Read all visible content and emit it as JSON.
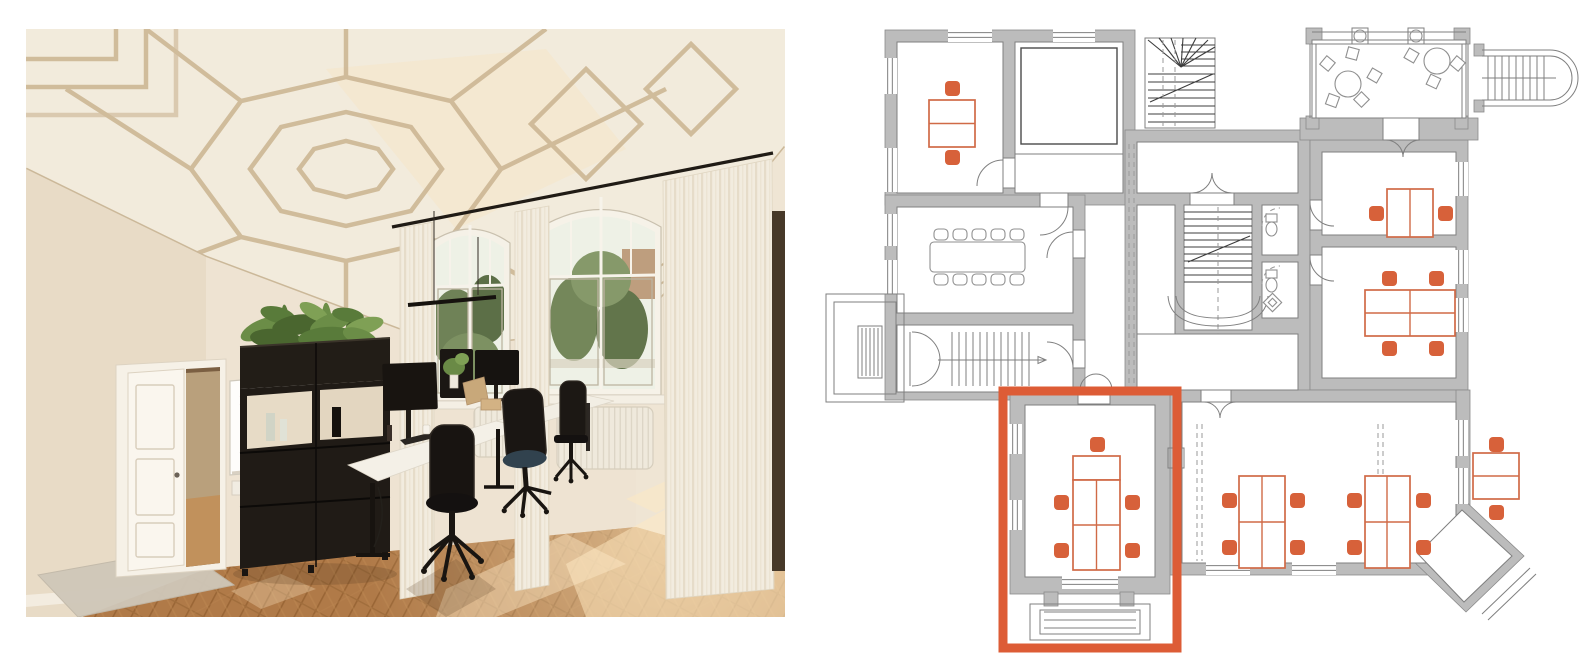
{
  "page": {
    "background": "#ffffff",
    "layout": "photo-left-floorplan-right"
  },
  "photo": {
    "palette": {
      "ceiling": "#f2ebdc",
      "ceiling_ribs": "#cdb795",
      "wall_back": "#eee3d2",
      "wall_left": "#e8dbc6",
      "floor_wood": "#b07a48",
      "floor_seam": "#9a6636",
      "sunlight": "#ffe9c2",
      "curtain": "#f2ecdf",
      "curtain_fold": "#e6dcc9",
      "window_sky": "#eef1e6",
      "window_trees": "#6f8257",
      "black_furniture": "#201b16",
      "desk_top": "#f4f0e7",
      "plant_green": "#6b8d47",
      "mat_gray": "#cfc7b9",
      "hall_through_door": "#c1915c",
      "curtain_rod": "#201b15"
    },
    "inventory": {
      "windows": 2,
      "monitors": 3,
      "office_chairs": 3,
      "doors_open": 1,
      "whiteboards": 1,
      "plant_divider_units": 1,
      "radiators": 2,
      "pendant_lights": 1
    }
  },
  "floor_plan": {
    "colors": {
      "wall": "#bcbcbc",
      "wall_stroke": "#8a8a8a",
      "line": "#7f7f7f",
      "dark": "#3c3c3c",
      "dash": "#9a9a9a",
      "gray_furniture": "#8f8f8f",
      "accent": "#d7613a",
      "desk_stroke": "#d06a47",
      "highlight": "#dd5c36",
      "room": "#ffffff"
    },
    "highlight_room": {
      "x": 1003,
      "y": 391,
      "w": 174,
      "h": 257,
      "stroke_width": 9
    },
    "walls": [
      [
        885,
        30,
        250,
        175
      ],
      [
        885,
        195,
        200,
        205
      ],
      [
        1125,
        130,
        185,
        270
      ],
      [
        1310,
        140,
        158,
        250
      ],
      [
        1170,
        390,
        298,
        185
      ],
      [
        1010,
        392,
        160,
        202
      ],
      [
        1300,
        118,
        178,
        22
      ],
      [
        1456,
        390,
        14,
        128
      ],
      [
        1306,
        28,
        16,
        16
      ],
      [
        1454,
        28,
        16,
        16
      ],
      [
        1306,
        116,
        13,
        13
      ],
      [
        1455,
        116,
        13,
        13
      ],
      [
        1044,
        592,
        14,
        14
      ],
      [
        1120,
        592,
        14,
        14
      ],
      [
        1474,
        44,
        10,
        12
      ],
      [
        1474,
        100,
        10,
        12
      ]
    ],
    "wall_polys": [
      "1462,498 1524,556 1466,612 1406,554"
    ],
    "rooms": [
      [
        897,
        42,
        106,
        151
      ],
      [
        1015,
        42,
        108,
        151
      ],
      [
        897,
        207,
        176,
        106
      ],
      [
        897,
        325,
        176,
        67
      ],
      [
        1137,
        142,
        161,
        51
      ],
      [
        1137,
        205,
        38,
        187
      ],
      [
        1184,
        205,
        68,
        125
      ],
      [
        1262,
        205,
        36,
        50
      ],
      [
        1262,
        262,
        36,
        56
      ],
      [
        1137,
        334,
        161,
        56
      ],
      [
        1322,
        152,
        134,
        83
      ],
      [
        1322,
        247,
        134,
        131
      ],
      [
        1182,
        402,
        274,
        161
      ],
      [
        1025,
        405,
        130,
        172
      ],
      [
        1312,
        40,
        154,
        78
      ],
      [
        1078,
        390,
        32,
        14
      ],
      [
        1383,
        118,
        36,
        22
      ],
      [
        1190,
        193,
        44,
        12
      ],
      [
        1310,
        200,
        12,
        30
      ],
      [
        1310,
        255,
        12,
        30
      ],
      [
        1201,
        390,
        30,
        12
      ],
      [
        1073,
        230,
        12,
        28
      ],
      [
        1073,
        340,
        12,
        28
      ],
      [
        1003,
        158,
        12,
        30
      ],
      [
        1040,
        193,
        28,
        14
      ]
    ],
    "room_polys": [
      "1462,510 1512,556 1464,602 1418,554"
    ],
    "windows": [
      [
        948,
        28,
        44,
        14
      ],
      [
        1053,
        28,
        42,
        14
      ],
      [
        883,
        58,
        14,
        36
      ],
      [
        883,
        148,
        14,
        44
      ],
      [
        883,
        214,
        14,
        32
      ],
      [
        883,
        260,
        14,
        34
      ],
      [
        1454,
        162,
        14,
        34
      ],
      [
        1454,
        250,
        14,
        34
      ],
      [
        1454,
        298,
        14,
        34
      ],
      [
        1454,
        420,
        14,
        36
      ],
      [
        1454,
        468,
        14,
        36
      ],
      [
        1206,
        561,
        44,
        14
      ],
      [
        1292,
        561,
        44,
        14
      ],
      [
        1062,
        575,
        56,
        14
      ],
      [
        1008,
        424,
        14,
        30
      ],
      [
        1008,
        500,
        14,
        30
      ]
    ],
    "outline_rects": [
      [
        826,
        294,
        78,
        108
      ],
      [
        834,
        302,
        62,
        92
      ],
      [
        858,
        326,
        24,
        52
      ],
      [
        1030,
        604,
        120,
        36
      ],
      [
        1040,
        610,
        100,
        24
      ],
      [
        1168,
        448,
        16,
        20
      ],
      [
        1352,
        28,
        16,
        16
      ],
      [
        1408,
        28,
        16,
        16
      ],
      [
        1145,
        38,
        70,
        90
      ]
    ],
    "dark_rects": [
      [
        1021,
        48,
        96,
        96
      ]
    ],
    "lines": [
      [
        1015,
        154,
        1123,
        154
      ],
      [
        1312,
        32,
        1466,
        32
      ],
      [
        1312,
        44,
        1466,
        44
      ],
      [
        1310,
        44,
        1310,
        118
      ],
      [
        1316,
        44,
        1316,
        118
      ],
      [
        1462,
        44,
        1462,
        118
      ],
      [
        1468,
        44,
        1468,
        118
      ],
      [
        1482,
        50,
        1550,
        50
      ],
      [
        1482,
        56,
        1550,
        56
      ],
      [
        1482,
        100,
        1550,
        100
      ],
      [
        1482,
        106,
        1550,
        106
      ],
      [
        1482,
        78,
        1556,
        78
      ],
      [
        910,
        332,
        910,
        386
      ],
      [
        938,
        360,
        1046,
        360
      ],
      [
        1482,
        614,
        1530,
        568
      ],
      [
        1488,
        620,
        1536,
        574
      ]
    ],
    "line_gens": [
      {
        "g": "tv",
        "x0": 862,
        "dx": 4,
        "n": 5,
        "y1": 328,
        "y2": 376
      },
      {
        "g": "th",
        "y0": 612,
        "dy": 8,
        "n": 3,
        "x1": 1044,
        "x2": 1136
      },
      {
        "g": "tv",
        "x0": 952,
        "dx": 7,
        "n": 12,
        "y1": 332,
        "y2": 386
      },
      {
        "g": "tv",
        "x0": 1488,
        "dx": 7,
        "n": 9,
        "y1": 56,
        "y2": 100
      }
    ],
    "dark_lines": [
      [
        1181,
        67,
        1148,
        40
      ],
      [
        1181,
        67,
        1159,
        38
      ],
      [
        1181,
        67,
        1171,
        38
      ],
      [
        1181,
        67,
        1183,
        38
      ],
      [
        1181,
        67,
        1196,
        38
      ],
      [
        1181,
        67,
        1208,
        40
      ],
      [
        1181,
        67,
        1215,
        47
      ],
      [
        1150,
        102,
        1213,
        74
      ],
      [
        1188,
        262,
        1250,
        236
      ]
    ],
    "dark_gens": [
      {
        "g": "th",
        "y0": 45,
        "dy": 7,
        "n": 4,
        "x1": 1181,
        "x2": 1215
      },
      {
        "g": "th",
        "y0": 74,
        "dy": 8,
        "n": 7,
        "x1": 1148,
        "x2": 1215
      },
      {
        "g": "th",
        "y0": 212,
        "dy": 7,
        "n": 11,
        "x1": 1184,
        "x2": 1252
      }
    ],
    "dashes": [
      [
        1129,
        144,
        1129,
        388
      ],
      [
        1134,
        144,
        1134,
        388
      ],
      [
        1197,
        424,
        1197,
        561
      ],
      [
        1202,
        424,
        1202,
        561
      ],
      [
        1378,
        424,
        1378,
        561
      ],
      [
        1383,
        424,
        1383,
        561
      ],
      [
        1218,
        207,
        1218,
        334
      ],
      [
        1163,
        40,
        1163,
        126
      ],
      [
        1175,
        40,
        1175,
        126
      ]
    ],
    "paths": [
      "M1168,296 Q1170,326 1218,326 Q1266,326 1268,296",
      "M1176,296 Q1178,318 1218,318 Q1258,318 1260,296",
      "M1550,50 A28,28 0 0 1 1550,106",
      "M1550,56 A22,22 0 0 1 1550,100",
      "M1003,160 A26,26 0 0 0 977,186",
      "M1068,207 A28,28 0 0 1 1040,235",
      "M1073,232 A26,26 0 0 0 1047,258",
      "M1073,368 A26,26 0 0 0 1047,342",
      "M1192,193 A20,20 0 0 0 1212,173",
      "M1232,193 A20,20 0 0 1 1212,173",
      "M1386,140 A17,17 0 0 1 1403,157",
      "M1420,140 A17,17 0 0 0 1403,157",
      "M1310,202 A24,24 0 0 0 1334,226",
      "M1310,257 A24,24 0 0 0 1334,281",
      "M1204,402 A16,16 0 0 1 1220,418",
      "M1236,402 A16,16 0 0 0 1220,418",
      "M1080,390 A16,16 0 0 1 1096,374",
      "M1112,390 A16,16 0 0 0 1096,374",
      "M912,332 A28,28 0 0 1 940,360",
      "M912,386 A28,28 0 0 0 940,358",
      "M1046,360 l-8,-3.5 l0,7 Z"
    ],
    "dash_paths": [
      "M1262,226 A18,18 0 0 1 1280,208",
      "M1262,284 A18,18 0 0 1 1280,266"
    ],
    "desks": [
      {
        "x": 929,
        "y": 100,
        "w": 46,
        "h": 47,
        "vx": [],
        "hy": [
          123.5
        ]
      },
      {
        "x": 1387,
        "y": 189,
        "w": 46,
        "h": 48,
        "vx": [
          1410
        ],
        "hy": []
      },
      {
        "x": 1365,
        "y": 290,
        "w": 90,
        "h": 46,
        "vx": [
          1410
        ],
        "hy": [
          313
        ]
      },
      {
        "x": 1073,
        "y": 456,
        "w": 47,
        "h": 24,
        "vx": [],
        "hy": []
      },
      {
        "x": 1073,
        "y": 480,
        "w": 47,
        "h": 90,
        "vx": [
          1096.5
        ],
        "hy": [
          525
        ]
      },
      {
        "x": 1239,
        "y": 476,
        "w": 46,
        "h": 92,
        "vx": [
          1262
        ],
        "hy": [
          522
        ]
      },
      {
        "x": 1365,
        "y": 476,
        "w": 45,
        "h": 92,
        "vx": [
          1387
        ],
        "hy": [
          522
        ]
      },
      {
        "x": 1473,
        "y": 453,
        "w": 46,
        "h": 46,
        "vx": [],
        "hy": [
          476
        ]
      }
    ],
    "chairs": [
      [
        945,
        81
      ],
      [
        945,
        150
      ],
      [
        1369,
        206
      ],
      [
        1438,
        206
      ],
      [
        1382,
        271
      ],
      [
        1429,
        271
      ],
      [
        1382,
        341
      ],
      [
        1429,
        341
      ],
      [
        1090,
        437
      ],
      [
        1054,
        495
      ],
      [
        1054,
        543
      ],
      [
        1125,
        495
      ],
      [
        1125,
        543
      ],
      [
        1222,
        493
      ],
      [
        1222,
        540
      ],
      [
        1290,
        493
      ],
      [
        1290,
        540
      ],
      [
        1347,
        493
      ],
      [
        1347,
        540
      ],
      [
        1416,
        493
      ],
      [
        1416,
        540
      ],
      [
        1489,
        437
      ],
      [
        1489,
        505
      ]
    ],
    "chair_size": 15,
    "conference": {
      "table": [
        930,
        242,
        95,
        30
      ],
      "chair_xs": [
        934,
        953,
        972,
        991,
        1010
      ],
      "rows_y": [
        229,
        274
      ],
      "chair_w": 14,
      "chair_h": 11
    },
    "round_tables": [
      [
        1348,
        84,
        13
      ],
      [
        1437,
        61,
        13
      ]
    ],
    "column_circles": [
      [
        1360,
        36,
        6
      ],
      [
        1416,
        36,
        6
      ]
    ],
    "terrace_chairs": [
      {
        "x": 1322,
        "y": 58,
        "rot": 40
      },
      {
        "x": 1347,
        "y": 48,
        "rot": 15
      },
      {
        "x": 1369,
        "y": 70,
        "rot": 30
      },
      {
        "x": 1356,
        "y": 94,
        "rot": 45
      },
      {
        "x": 1327,
        "y": 95,
        "rot": 20
      },
      {
        "x": 1406,
        "y": 50,
        "rot": 30
      },
      {
        "x": 1452,
        "y": 58,
        "rot": 40
      },
      {
        "x": 1428,
        "y": 76,
        "rot": 25
      }
    ],
    "terrace_chair_size": 11,
    "toilet_rects": [
      [
        1266,
        214,
        11,
        8
      ],
      [
        1266,
        270,
        11,
        8
      ]
    ],
    "toilet_bowls": [
      [
        1271.5,
        229,
        5.5,
        7
      ],
      [
        1271.5,
        285,
        5.5,
        7
      ]
    ],
    "sink": [
      {
        "x": 1266,
        "y": 296,
        "s": 13,
        "rot": 45
      },
      {
        "x": 1269.5,
        "y": 299.5,
        "s": 6,
        "rot": 45
      }
    ]
  }
}
